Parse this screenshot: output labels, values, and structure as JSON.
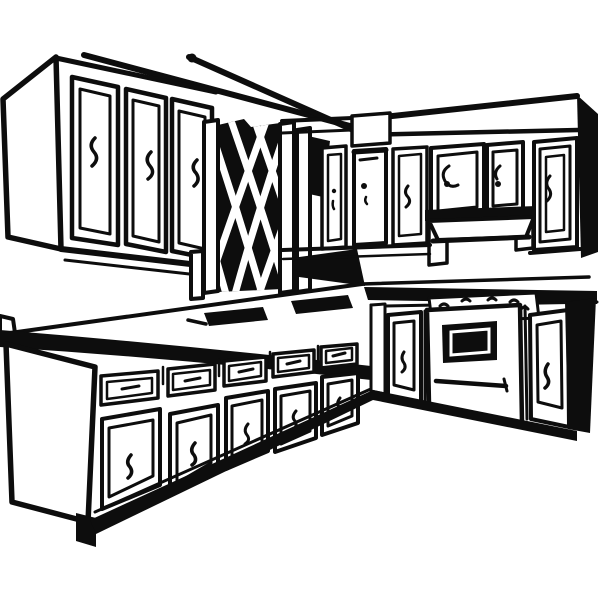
{
  "image": {
    "title": "Black and white clip-art line drawing of an L-shaped kitchen",
    "description": "Retro woodcut-style illustration of a kitchen corner: upper wall cabinets on the left, a diamond-lattice cabinet panel in the center, upper cabinets with a range hood on the right wall, an L-shaped countertop with inset sink and cooktop marks, base cabinets with drawers and doors, and a built-in wall oven on the right run. No text appears in the image.",
    "colors": {
      "ink": "#0d0d0d",
      "paper": "#ffffff"
    }
  },
  "labels": {
    "scene": "kitchen line-art scene",
    "upper_left_run": "upper cabinet run on left wall",
    "upper_left_side_panel": "left end panel of upper cabinets",
    "crown_molding": "crown molding lines",
    "upper_left_doors": "three upper cabinet doors with handles",
    "lattice_panel": "diamond lattice cabinet panel",
    "lattice_frame": "lattice frame stiles and posts",
    "corner_shadow": "shadow in wall corner",
    "corner_cabinets": "narrow corner upper cabinet doors",
    "soffit_panel": "soffit face panel",
    "right_upper_run": "upper cabinet run on right wall",
    "right_upper_doors": "square cabinet doors with spiral knobs",
    "range_hood": "range hood under upper cabinets",
    "right_end_door": "tall right-end upper door",
    "right_side_shadow": "black shaded end of right cabinets",
    "countertop": "L-shaped countertop",
    "backsplash_step": "backsplash ledge at left edge",
    "sink_insets": "dark inset sink and cooktop openings on counter",
    "base_left_run": "base cabinet run on left with drawers and doors",
    "base_side_panel": "left end panel of base cabinets",
    "toe_kick": "toe kick shadow band",
    "base_right_run": "base cabinet run on right",
    "oven": "built-in oven",
    "oven_window": "dark oven door window",
    "oven_handle": "oven door handle",
    "cooktop": "cooktop surface with burner marks",
    "end_panel_shadow": "black end panel of right base run"
  }
}
